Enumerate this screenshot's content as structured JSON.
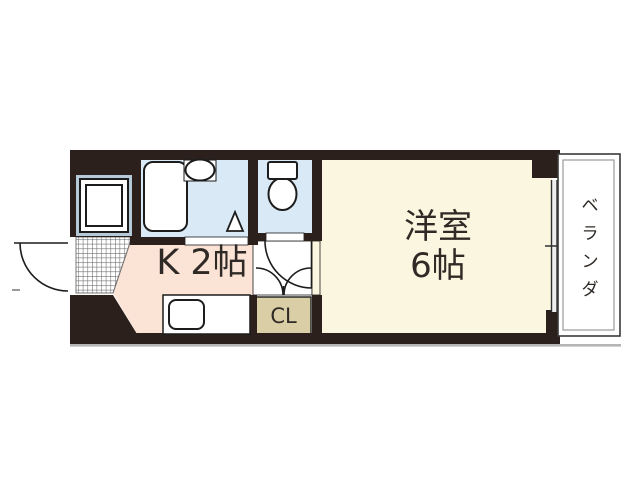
{
  "rooms": {
    "kitchen": {
      "label": "K 2帖"
    },
    "western_room": {
      "label_line1": "洋室",
      "label_line2": "6帖"
    },
    "closet": {
      "label": "CL"
    },
    "veranda": {
      "label": "ベランダ"
    }
  },
  "colors": {
    "wall": "#2b201b",
    "bath": "#d9e9f5",
    "kitchen": "#fbe4d5",
    "room": "#fbf6df",
    "closet": "#d9cea6",
    "line": "#1c1c1c"
  }
}
